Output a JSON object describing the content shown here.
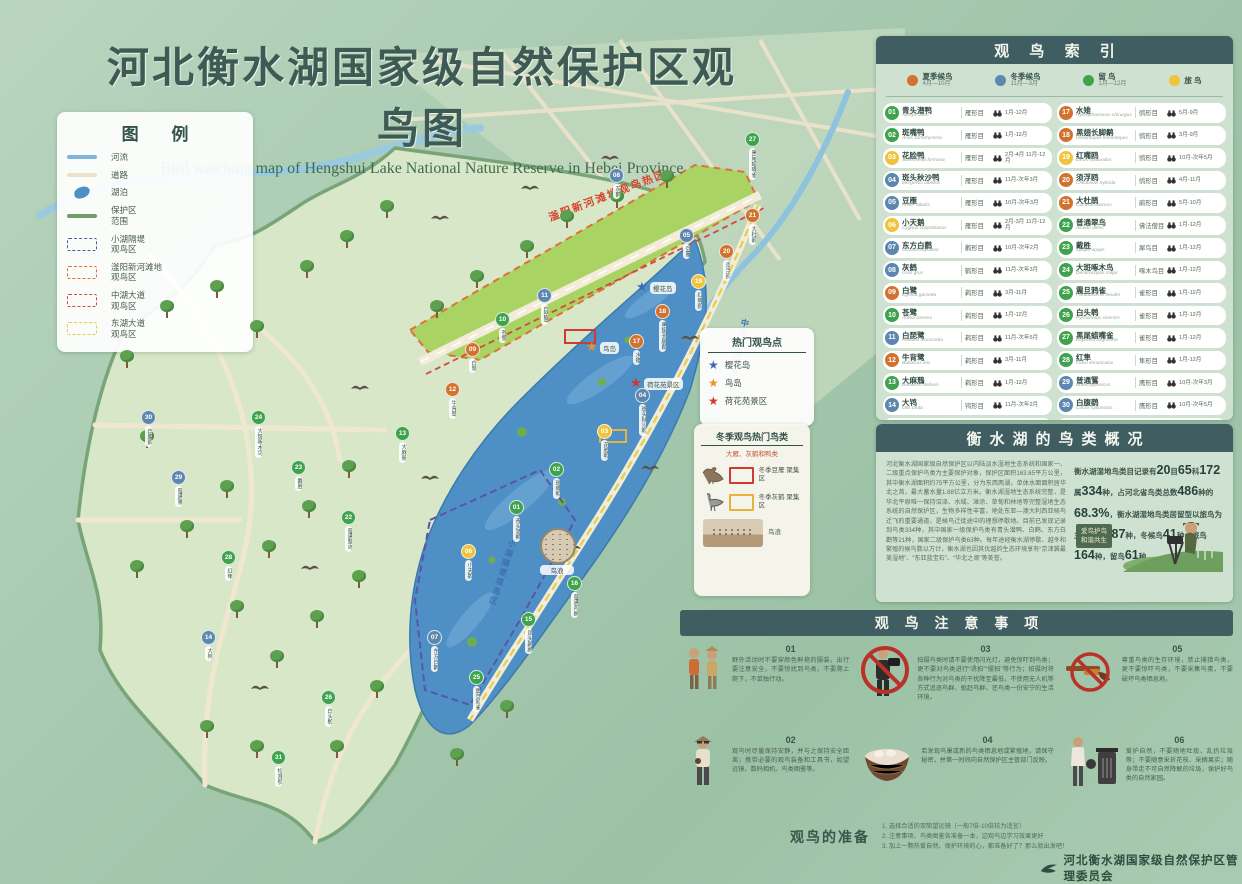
{
  "title": "河北衡水湖国家级自然保护区观鸟图",
  "subtitle": "Bird watching map of Hengshui Lake National Nature Reserve in Hebei Province",
  "colors": {
    "summer": "#d2722f",
    "winter": "#5d87ae",
    "resident": "#3fa34d",
    "passage": "#f0c33c",
    "panel_header": "#405d61",
    "panel_bg": "#cfe2d2",
    "zone_xiaohu": "#5a55a8",
    "zone_fuyang": "#e0703a",
    "zone_zhonghu": "#cf4a42",
    "zone_donghu": "#e3cf4e",
    "river": "#7fb5d8",
    "road": "#ece2c6",
    "lake": "#4e8fc6",
    "boundary": "#6f9e6a"
  },
  "legend": {
    "title": "图 例",
    "items": [
      {
        "type": "river",
        "label": "河流"
      },
      {
        "type": "road",
        "label": "道路"
      },
      {
        "type": "lake",
        "label": "湖泊"
      },
      {
        "type": "boundary",
        "label": "保护区\n范围"
      },
      {
        "type": "zone_xiaohu",
        "label": "小湖隔堤\n观鸟区"
      },
      {
        "type": "zone_fuyang",
        "label": "滏阳新河滩地\n观鸟区"
      },
      {
        "type": "zone_zhonghu",
        "label": "中湖大道\n观鸟区"
      },
      {
        "type": "zone_donghu",
        "label": "东湖大道\n观鸟区"
      }
    ]
  },
  "hotspots": {
    "title": "热门观鸟点",
    "items": [
      {
        "star": "#3a6bb5",
        "label": "樱花岛"
      },
      {
        "star": "#e8922a",
        "label": "鸟岛"
      },
      {
        "star": "#d4342c",
        "label": "荷花苑景区"
      }
    ]
  },
  "winter_popular": {
    "title": "冬季观鸟热门鸟类",
    "subtitle": "大雁、灰鹤和鸭类",
    "items": [
      {
        "icon": "goose",
        "box": "#cf3a32",
        "label": "冬季豆雁\n聚集区"
      },
      {
        "icon": "crane",
        "box": "#e8b33c",
        "label": "冬季灰鹤\n聚集区"
      }
    ],
    "photo_label": "鸟浪"
  },
  "index": {
    "title": "观 鸟 索 引",
    "seasons": [
      {
        "label": "夏季候鸟",
        "range": "4月—10月",
        "type": "summer"
      },
      {
        "label": "冬季候鸟",
        "range": "11月—3月",
        "type": "winter"
      },
      {
        "label": "留  鸟",
        "range": "1月—12月",
        "type": "resident"
      },
      {
        "label": "旅  鸟",
        "range": "",
        "type": "passage"
      }
    ],
    "birds": [
      {
        "num": "01",
        "name": "青头潜鸭",
        "latin": "Aythya baeri",
        "order": "雁形目",
        "months": "1月-12月",
        "type": "resident"
      },
      {
        "num": "02",
        "name": "斑嘴鸭",
        "latin": "Anas zonorhyncha",
        "order": "雁形目",
        "months": "1月-12月",
        "type": "resident"
      },
      {
        "num": "03",
        "name": "花脸鸭",
        "latin": "Sibirionetta formosa",
        "order": "雁形目",
        "months": "2月-4月 11月-12月",
        "type": "passage"
      },
      {
        "num": "04",
        "name": "斑头秋沙鸭",
        "latin": "Mergellus albellus",
        "order": "雁形目",
        "months": "11月-次年3月",
        "type": "winter"
      },
      {
        "num": "05",
        "name": "豆雁",
        "latin": "Anser fabalis",
        "order": "雁形目",
        "months": "10月-次年3月",
        "type": "winter"
      },
      {
        "num": "06",
        "name": "小天鹅",
        "latin": "Cygnus columbianus",
        "order": "雁形目",
        "months": "2月-3月 11月-12月",
        "type": "passage"
      },
      {
        "num": "07",
        "name": "东方白鹳",
        "latin": "Ciconia boyciana",
        "order": "鹳形目",
        "months": "10月-次年2月",
        "type": "winter"
      },
      {
        "num": "08",
        "name": "灰鹤",
        "latin": "Grus grus",
        "order": "鹤形目",
        "months": "11月-次年3月",
        "type": "winter"
      },
      {
        "num": "09",
        "name": "白鹭",
        "latin": "Egretta garzetta",
        "order": "鹈形目",
        "months": "3月-11月",
        "type": "summer"
      },
      {
        "num": "10",
        "name": "苍鹭",
        "latin": "Ardea cinerea",
        "order": "鹈形目",
        "months": "1月-12月",
        "type": "resident"
      },
      {
        "num": "11",
        "name": "白琵鹭",
        "latin": "Platalea leucorodia",
        "order": "鹈形目",
        "months": "11月-次年5月",
        "type": "winter"
      },
      {
        "num": "12",
        "name": "牛背鹭",
        "latin": "Bubulcus ibis",
        "order": "鹈形目",
        "months": "3月-11月",
        "type": "summer"
      },
      {
        "num": "13",
        "name": "大麻鳽",
        "latin": "Botaurus stellaris",
        "order": "鹈形目",
        "months": "1月-12月",
        "type": "resident"
      },
      {
        "num": "14",
        "name": "大鸨",
        "latin": "Otis tarda",
        "order": "鸨形目",
        "months": "11月-次年2月",
        "type": "winter"
      },
      {
        "num": "15",
        "name": "凤头䴙䴘",
        "latin": "Podiceps cristatus",
        "order": "䴙䴘目",
        "months": "1月-12月",
        "type": "resident"
      },
      {
        "num": "16",
        "name": "普通鸬鹚",
        "latin": "Phalacrocorax carbo",
        "order": "鲣鸟目",
        "months": "1月-12月",
        "type": "resident"
      },
      {
        "num": "17",
        "name": "水雉",
        "latin": "Hydrophasianus chirurgus",
        "order": "鸻形目",
        "months": "5月-9月",
        "type": "summer"
      },
      {
        "num": "18",
        "name": "黑翅长脚鹬",
        "latin": "Himantopus himantopus",
        "order": "鸻形目",
        "months": "3月-9月",
        "type": "summer"
      },
      {
        "num": "19",
        "name": "红嘴鸥",
        "latin": "Larus ridibundus",
        "order": "鸻形目",
        "months": "10月-次年5月",
        "type": "passage"
      },
      {
        "num": "20",
        "name": "须浮鸥",
        "latin": "Chlidonias hybrida",
        "order": "鸻形目",
        "months": "4月-11月",
        "type": "summer"
      },
      {
        "num": "21",
        "name": "大杜鹃",
        "latin": "Cuculus canorus",
        "order": "鹃形目",
        "months": "5月-10月",
        "type": "summer"
      },
      {
        "num": "22",
        "name": "普通翠鸟",
        "latin": "Alcedo atthis",
        "order": "佛法僧目",
        "months": "1月-12月",
        "type": "resident"
      },
      {
        "num": "23",
        "name": "戴胜",
        "latin": "Upupa epops",
        "order": "犀鸟目",
        "months": "1月-12月",
        "type": "resident"
      },
      {
        "num": "24",
        "name": "大斑啄木鸟",
        "latin": "Dendrocopos major",
        "order": "啄木鸟目",
        "months": "1月-12月",
        "type": "resident"
      },
      {
        "num": "25",
        "name": "震旦鸦雀",
        "latin": "Paradoxornis heudei",
        "order": "雀形目",
        "months": "1月-12月",
        "type": "resident"
      },
      {
        "num": "26",
        "name": "白头鹎",
        "latin": "Pycnonotus sinensis",
        "order": "雀形目",
        "months": "1月-12月",
        "type": "resident"
      },
      {
        "num": "27",
        "name": "黑尾蜡嘴雀",
        "latin": "Eophona migratoria",
        "order": "雀形目",
        "months": "1月-12月",
        "type": "resident"
      },
      {
        "num": "28",
        "name": "红隼",
        "latin": "Falco tinnunculus",
        "order": "隼形目",
        "months": "1月-12月",
        "type": "resident"
      },
      {
        "num": "29",
        "name": "普通鵟",
        "latin": "Buteo japonicus",
        "order": "鹰形目",
        "months": "10月-次年3月",
        "type": "winter"
      },
      {
        "num": "30",
        "name": "白腹鹞",
        "latin": "Circus spilonotus",
        "order": "鹰形目",
        "months": "10月-次年5月",
        "type": "winter"
      },
      {
        "num": "31",
        "name": "短耳鸮",
        "latin": "Asio flammeus",
        "order": "鸮形目",
        "months": "1月-12月",
        "type": "resident"
      }
    ]
  },
  "overview": {
    "title": "衡水湖的鸟类概况",
    "para1": "河北衡水湖国家级自然保护区以内陆淡水湿地生态系统和国家一、二级重点保护鸟类为主要保护对象，保护区面积163.65平方公里，其中衡水湖面积约75平方公里，分为东西两湖，单体水面面积居华北之首，最大蓄水量1.88亿立方米。衡水湖湿地生态系统完整，是华北平原唯一保持沼泽、水域、滩涂、草甸和林地等完整湿地生态系统的自然保护区，生物多样性丰富，地处东亚—澳大利西亚候鸟迁飞的重要通道，是候鸟迁徙途中的理想停歇地。目前已发现记录到鸟类334种，其中国家一级保护鸟类有青头潜鸭、白鹤、东方白鹳等21种，国家二级保护鸟类63种。每年途经衡水湖停歇、越冬和繁殖的候鸟数以万计，衡水湖也因其优越的生态环境享有“京津冀最美湿地”、“东亚蓝宝石”、“华北之肾”等美誉。",
    "para2_segments": [
      {
        "t": "衡水湖湿地鸟类目记录有"
      },
      {
        "t": "20",
        "big": true
      },
      {
        "t": "目"
      },
      {
        "t": "65",
        "big": true
      },
      {
        "t": "科"
      },
      {
        "t": "172",
        "big": true
      },
      {
        "t": "属"
      },
      {
        "t": "334",
        "big": true
      },
      {
        "t": "种，占河北省鸟类总数"
      },
      {
        "t": "486",
        "big": true
      },
      {
        "t": "种的"
      },
      {
        "t": "68.3%",
        "big": true
      },
      {
        "t": "，衡水湖湿地鸟类居留型以旅鸟为主，夏候鸟"
      },
      {
        "t": "87",
        "big": true
      },
      {
        "t": "种，冬候鸟"
      },
      {
        "t": "41",
        "big": true
      },
      {
        "t": "种，旅鸟"
      },
      {
        "t": "164",
        "big": true
      },
      {
        "t": "种，留鸟"
      },
      {
        "t": "61",
        "big": true
      },
      {
        "t": "种。"
      }
    ],
    "sign_text": "爱鸟护鸟\n和谐共生"
  },
  "precautions": {
    "title": "观 鸟 注 意 事 项",
    "items": [
      {
        "num": "01",
        "icon": "hikers",
        "text": "野外活动时不要穿颜色鲜艳的服装，出行要注意安全，不要惊扰到鸟类，不要爬上爬下，不单独行动。"
      },
      {
        "num": "03",
        "icon": "no-camera",
        "text": "拍摄鸟类时请不要使用闪光灯，避免惊吓到鸟类；更不要对鸟类进行“诱拍”“摆拍”等行为；拍摄时将各种行为对鸟类的干扰降至最低，不使用无人机等方式追逐鸟群、驱赶鸟群，还鸟类一份安宁的生活环境。"
      },
      {
        "num": "05",
        "icon": "no-gun",
        "text": "尊重鸟类的生存环境，禁止捕猎鸟类，更不要惊吓鸟类，不要采集鸟蛋，不要破坏鸟类栖息地。"
      },
      {
        "num": "02",
        "icon": "binoculars",
        "text": "观鸟时尽量保持安静，并与之保持安全距离；携带必要的观鸟装备和工具书，如望远镜、数码相机、鸟类图鉴等。"
      },
      {
        "num": "04",
        "icon": "nest",
        "text": "若发现鸟巢或新的鸟类栖息地或繁殖地，请保守秘密，并第一时间向自然保护区主管部门反映。"
      },
      {
        "num": "06",
        "icon": "trash",
        "text": "爱护自然，不要随地吐痰、乱扔垃圾等；不要随意采折花枝、采摘果实；随身带走不可自然降解的垃圾，保护好鸟类的自然家园。"
      }
    ]
  },
  "preparation": {
    "title": "观鸟的准备",
    "lines": [
      "1. 选择合适的双筒望远镜（一般7倍-10倍较为适宜）",
      "2. 注意事项、鸟类图鉴各准备一本，边观鸟边学习效果更好",
      "3. 加上一颗热爱自然、保护环境的心，都准备好了？那么就出发吧！"
    ]
  },
  "footer": {
    "org": "河北衡水湖国家级自然保护区管理委员会"
  },
  "map": {
    "hot_zone_label": "滏阳新河滩地观鸟热区",
    "vlabels": [
      "小湖隔堤观鸟区",
      "中湖大道观鸟区"
    ],
    "birdwave_label": "鸟浪",
    "stars": [
      {
        "x": 636,
        "y": 280,
        "color": "#3a6bb5",
        "label": "樱花岛"
      },
      {
        "x": 586,
        "y": 340,
        "color": "#e8922a",
        "label": "鸟岛"
      },
      {
        "x": 630,
        "y": 376,
        "color": "#d4342c",
        "label": "荷花苑景区"
      }
    ],
    "markers": [
      {
        "n": "01",
        "x": 516,
        "y": 506
      },
      {
        "n": "02",
        "x": 556,
        "y": 468
      },
      {
        "n": "03",
        "x": 604,
        "y": 430
      },
      {
        "n": "04",
        "x": 642,
        "y": 394
      },
      {
        "n": "05",
        "x": 686,
        "y": 234
      },
      {
        "n": "06",
        "x": 468,
        "y": 550
      },
      {
        "n": "07",
        "x": 434,
        "y": 636
      },
      {
        "n": "08",
        "x": 616,
        "y": 174
      },
      {
        "n": "09",
        "x": 472,
        "y": 348
      },
      {
        "n": "10",
        "x": 502,
        "y": 318
      },
      {
        "n": "11",
        "x": 544,
        "y": 294
      },
      {
        "n": "12",
        "x": 452,
        "y": 388
      },
      {
        "n": "13",
        "x": 402,
        "y": 432
      },
      {
        "n": "14",
        "x": 208,
        "y": 636
      },
      {
        "n": "15",
        "x": 528,
        "y": 618
      },
      {
        "n": "16",
        "x": 574,
        "y": 582
      },
      {
        "n": "17",
        "x": 636,
        "y": 340
      },
      {
        "n": "18",
        "x": 662,
        "y": 310
      },
      {
        "n": "19",
        "x": 698,
        "y": 280
      },
      {
        "n": "20",
        "x": 726,
        "y": 250
      },
      {
        "n": "21",
        "x": 752,
        "y": 214
      },
      {
        "n": "22",
        "x": 348,
        "y": 516
      },
      {
        "n": "23",
        "x": 298,
        "y": 466
      },
      {
        "n": "24",
        "x": 258,
        "y": 416
      },
      {
        "n": "25",
        "x": 476,
        "y": 676
      },
      {
        "n": "26",
        "x": 328,
        "y": 696
      },
      {
        "n": "27",
        "x": 752,
        "y": 138
      },
      {
        "n": "28",
        "x": 228,
        "y": 556
      },
      {
        "n": "29",
        "x": 178,
        "y": 476
      },
      {
        "n": "30",
        "x": 148,
        "y": 416
      },
      {
        "n": "31",
        "x": 278,
        "y": 756
      }
    ],
    "trees": [
      [
        120,
        350
      ],
      [
        160,
        300
      ],
      [
        210,
        280
      ],
      [
        250,
        320
      ],
      [
        300,
        260
      ],
      [
        340,
        230
      ],
      [
        380,
        200
      ],
      [
        140,
        430
      ],
      [
        180,
        520
      ],
      [
        130,
        560
      ],
      [
        220,
        480
      ],
      [
        262,
        540
      ],
      [
        302,
        500
      ],
      [
        342,
        460
      ],
      [
        230,
        600
      ],
      [
        270,
        650
      ],
      [
        310,
        610
      ],
      [
        352,
        570
      ],
      [
        200,
        720
      ],
      [
        250,
        740
      ],
      [
        330,
        740
      ],
      [
        370,
        680
      ],
      [
        430,
        300
      ],
      [
        470,
        270
      ],
      [
        520,
        240
      ],
      [
        560,
        210
      ],
      [
        610,
        190
      ],
      [
        660,
        170
      ],
      [
        450,
        748
      ],
      [
        500,
        700
      ]
    ],
    "silhouettes": [
      [
        430,
        210
      ],
      [
        520,
        180
      ],
      [
        600,
        150
      ],
      [
        350,
        380
      ],
      [
        420,
        470
      ],
      [
        562,
        540
      ],
      [
        640,
        460
      ],
      [
        300,
        560
      ],
      [
        250,
        680
      ],
      [
        680,
        330
      ]
    ]
  }
}
